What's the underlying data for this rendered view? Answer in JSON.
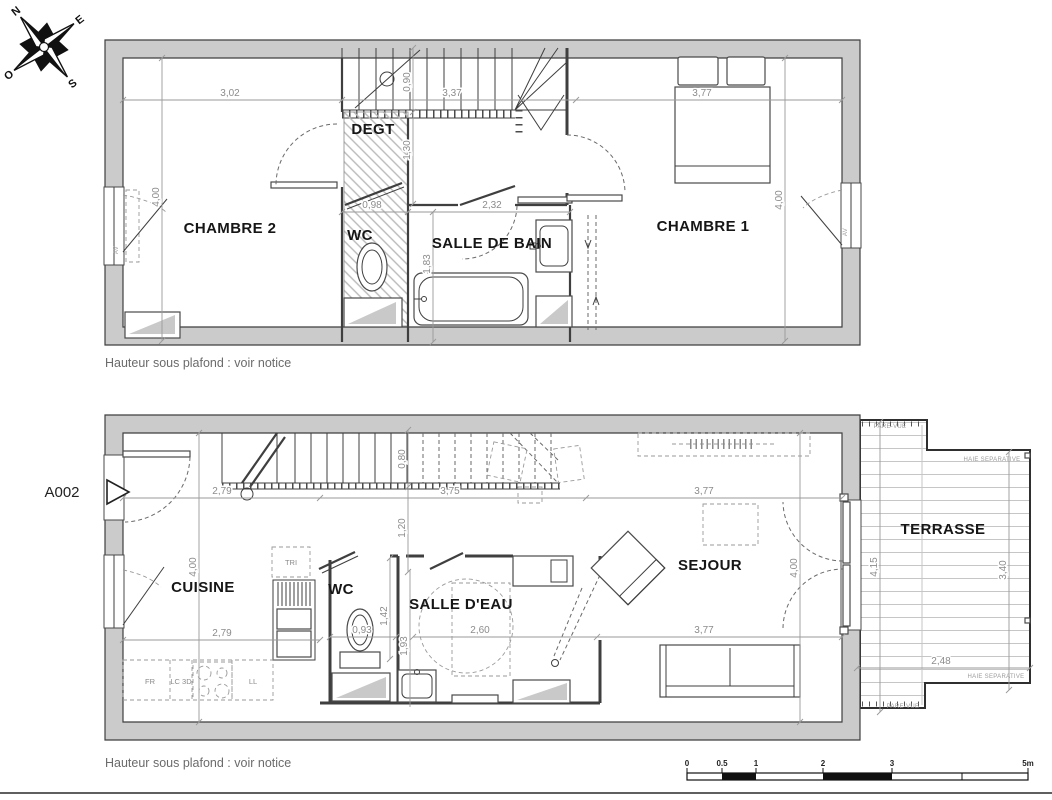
{
  "colors": {
    "wall_fill": "#cbcbcb",
    "line": "#3f3f3f",
    "dim_text": "#8c8c8c",
    "room_label": "#161616",
    "note_text": "#6b6b6b",
    "background": "#ffffff"
  },
  "compass": {
    "north": "N",
    "east": "E",
    "south": "S",
    "west": "O"
  },
  "entry_label": "A002",
  "notes": {
    "upper": "Hauteur sous plafond : voir notice",
    "lower": "Hauteur sous plafond : voir notice"
  },
  "floor_upper": {
    "rooms": {
      "chambre2": "CHAMBRE 2",
      "degt": "DEGT",
      "wc": "WC",
      "salle_de_bain": "SALLE DE BAIN",
      "chambre1": "CHAMBRE 1"
    },
    "dims": {
      "w_chambre2": "3,02",
      "w_stairs": "3,37",
      "w_chambre1": "3,77",
      "h_left": "4,00",
      "h_right": "4,00",
      "stair_depth": "0,90",
      "landing": "1,30",
      "w_wc": "0,98",
      "w_sdb": "2,32",
      "h_sdb": "1,83"
    },
    "window_tags": {
      "left": "AV",
      "right": "AV"
    }
  },
  "floor_lower": {
    "rooms": {
      "cuisine": "CUISINE",
      "wc": "WC",
      "salle_eau": "SALLE D'EAU",
      "sejour": "SEJOUR",
      "terrasse": "TERRASSE"
    },
    "dims": {
      "w_cuisine": "2,79",
      "w_stairs": "3,75",
      "w_sejour": "3,77",
      "stair_depth": "0,80",
      "landing": "1,20",
      "h_left": "4,00",
      "h_right": "4,00",
      "w_wc": "0,93",
      "h_wc": "1,42",
      "h_sde": "1,93",
      "w_sde": "2,60",
      "w_cuisine_b": "2,79",
      "w_sejour_b": "3,77",
      "terr_h_left": "4,15",
      "terr_h_right": "3,40",
      "terr_w": "2,48"
    },
    "appliances": {
      "tri": "TRI",
      "fr": "FR",
      "lc": "LC 3D",
      "ll": "LL"
    },
    "terrace_tags": {
      "pare_vue_top": "PARE-VUE",
      "haie_top": "HAIE SEPARATIVE",
      "haie_bottom": "HAIE SEPARATIVE",
      "pare_vue_bottom": "PARE-VUE"
    }
  },
  "scale_bar": {
    "labels": [
      "0",
      "0.5",
      "1",
      "2",
      "3",
      "5m"
    ]
  }
}
